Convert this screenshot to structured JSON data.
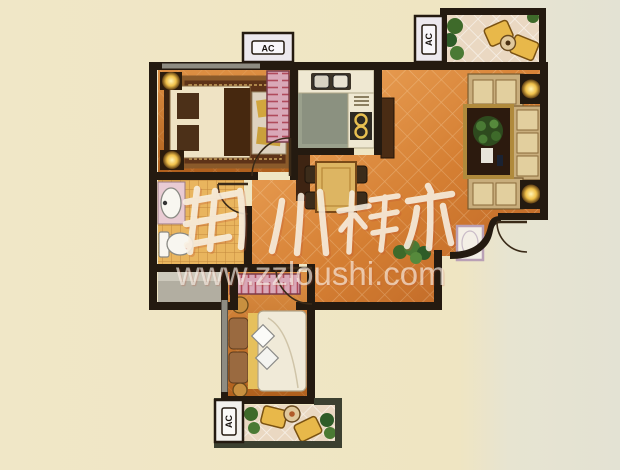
{
  "labels": {
    "ac": "AC"
  },
  "watermark": {
    "brand": "郑州楼市",
    "url": "www.zzloushi.com",
    "brand_color": "#f8f1e2",
    "url_color": "rgba(251,248,241,0.62)"
  },
  "colors": {
    "background_left": "#efe6c4",
    "background_right": "#e3e2d3",
    "wall": "#241a10",
    "balcony_wall": "#3c4030",
    "floor_orange": "#d07c31",
    "floor_tile_bath": "#e8b45f",
    "floor_kitchen": "#9aa08c",
    "floor_balcony": "#ead8c2",
    "wardrobe_pink": "#d9a8b8",
    "wardrobe_stripe": "#b04a5c",
    "lamp_glow": "#f5d060",
    "sofa_cream": "#ddc693",
    "table_dark_wood": "#2c1a0e",
    "window_band": "#8e8c82"
  },
  "plan": {
    "type": "apartment-floor-plan",
    "ac_units": [
      {
        "position": "top",
        "label": "AC"
      },
      {
        "position": "right",
        "label": "AC"
      },
      {
        "position": "bottom",
        "label": "AC"
      }
    ],
    "rooms": [
      {
        "name": "master-bedroom",
        "furniture": [
          "double-bed",
          "area-rug",
          "bedside-lamps",
          "bench",
          "wardrobe"
        ]
      },
      {
        "name": "bathroom",
        "furniture": [
          "sink",
          "toilet"
        ]
      },
      {
        "name": "utility-room",
        "furniture": []
      },
      {
        "name": "kitchen",
        "furniture": [
          "double-sink",
          "stove",
          "counter"
        ]
      },
      {
        "name": "dining-area",
        "furniture": [
          "dining-table",
          "chairs"
        ]
      },
      {
        "name": "living-room",
        "furniture": [
          "sofa-set",
          "coffee-table",
          "corner-lamps",
          "tv-cabinet",
          "plant",
          "doormat"
        ]
      },
      {
        "name": "second-bedroom",
        "furniture": [
          "double-bed",
          "wardrobe",
          "stools"
        ]
      },
      {
        "name": "balcony-top",
        "furniture": [
          "lounge-chairs",
          "round-table",
          "plants"
        ]
      },
      {
        "name": "balcony-bottom",
        "furniture": [
          "lounge-chairs",
          "round-table",
          "plants"
        ]
      }
    ]
  }
}
